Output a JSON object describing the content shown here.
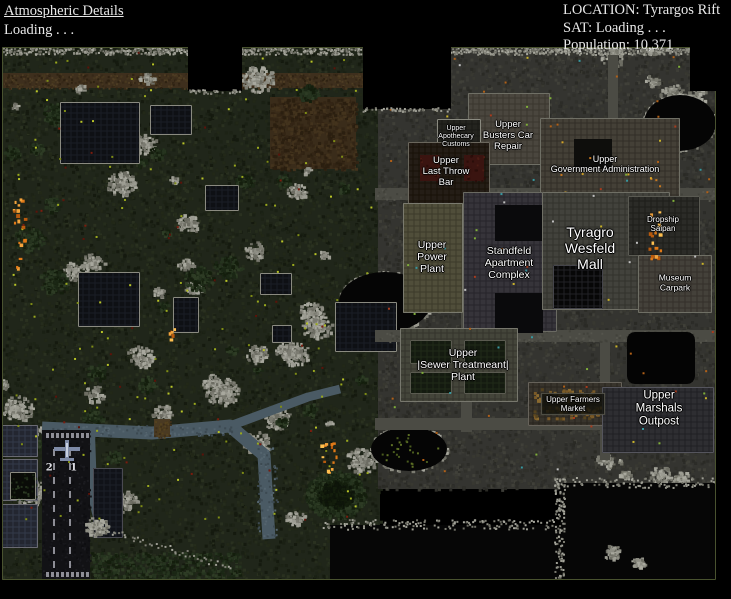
{
  "header": {
    "left": {
      "title": "Atmospheric Details",
      "status": "Loading . . ."
    },
    "right": {
      "location": "LOCATION: Tyrargos Rift",
      "sat": "SAT: Loading . . .",
      "population": "Population: 10,371"
    }
  },
  "map": {
    "runway_marking": "2 1",
    "labels": [
      {
        "id": "upper-apothecary-customs",
        "text": "Upper\nApothecary\nCustoms"
      },
      {
        "id": "upper-busters-car-repair",
        "text": "Upper\nBusters Car\nRepair"
      },
      {
        "id": "upper-last-throw-bar",
        "text": "Upper\nLast Throw\nBar"
      },
      {
        "id": "upper-government-administration",
        "text": "Upper\nGovernment Administration"
      },
      {
        "id": "upper-power-plant",
        "text": "Upper\nPower\nPlant"
      },
      {
        "id": "standfeld-apartment-complex",
        "text": "Standfeld\nApartment\nComplex"
      },
      {
        "id": "tyragro-wesfeld-mall",
        "text": "Tyragro\nWesfeld\nMall"
      },
      {
        "id": "dropship-saipan",
        "text": "Dropship\nSaipan"
      },
      {
        "id": "museum-carpark",
        "text": "Museum\nCarpark"
      },
      {
        "id": "upper-sewer-treatmeant-plant",
        "text": "Upper\n|Sewer Treatmeant|\nPlant"
      },
      {
        "id": "upper-farmers-market",
        "text": "Upper Farmers\nMarket"
      },
      {
        "id": "upper-marshals-outpost",
        "text": "Upper\nMarshals\nOutpost"
      }
    ]
  }
}
